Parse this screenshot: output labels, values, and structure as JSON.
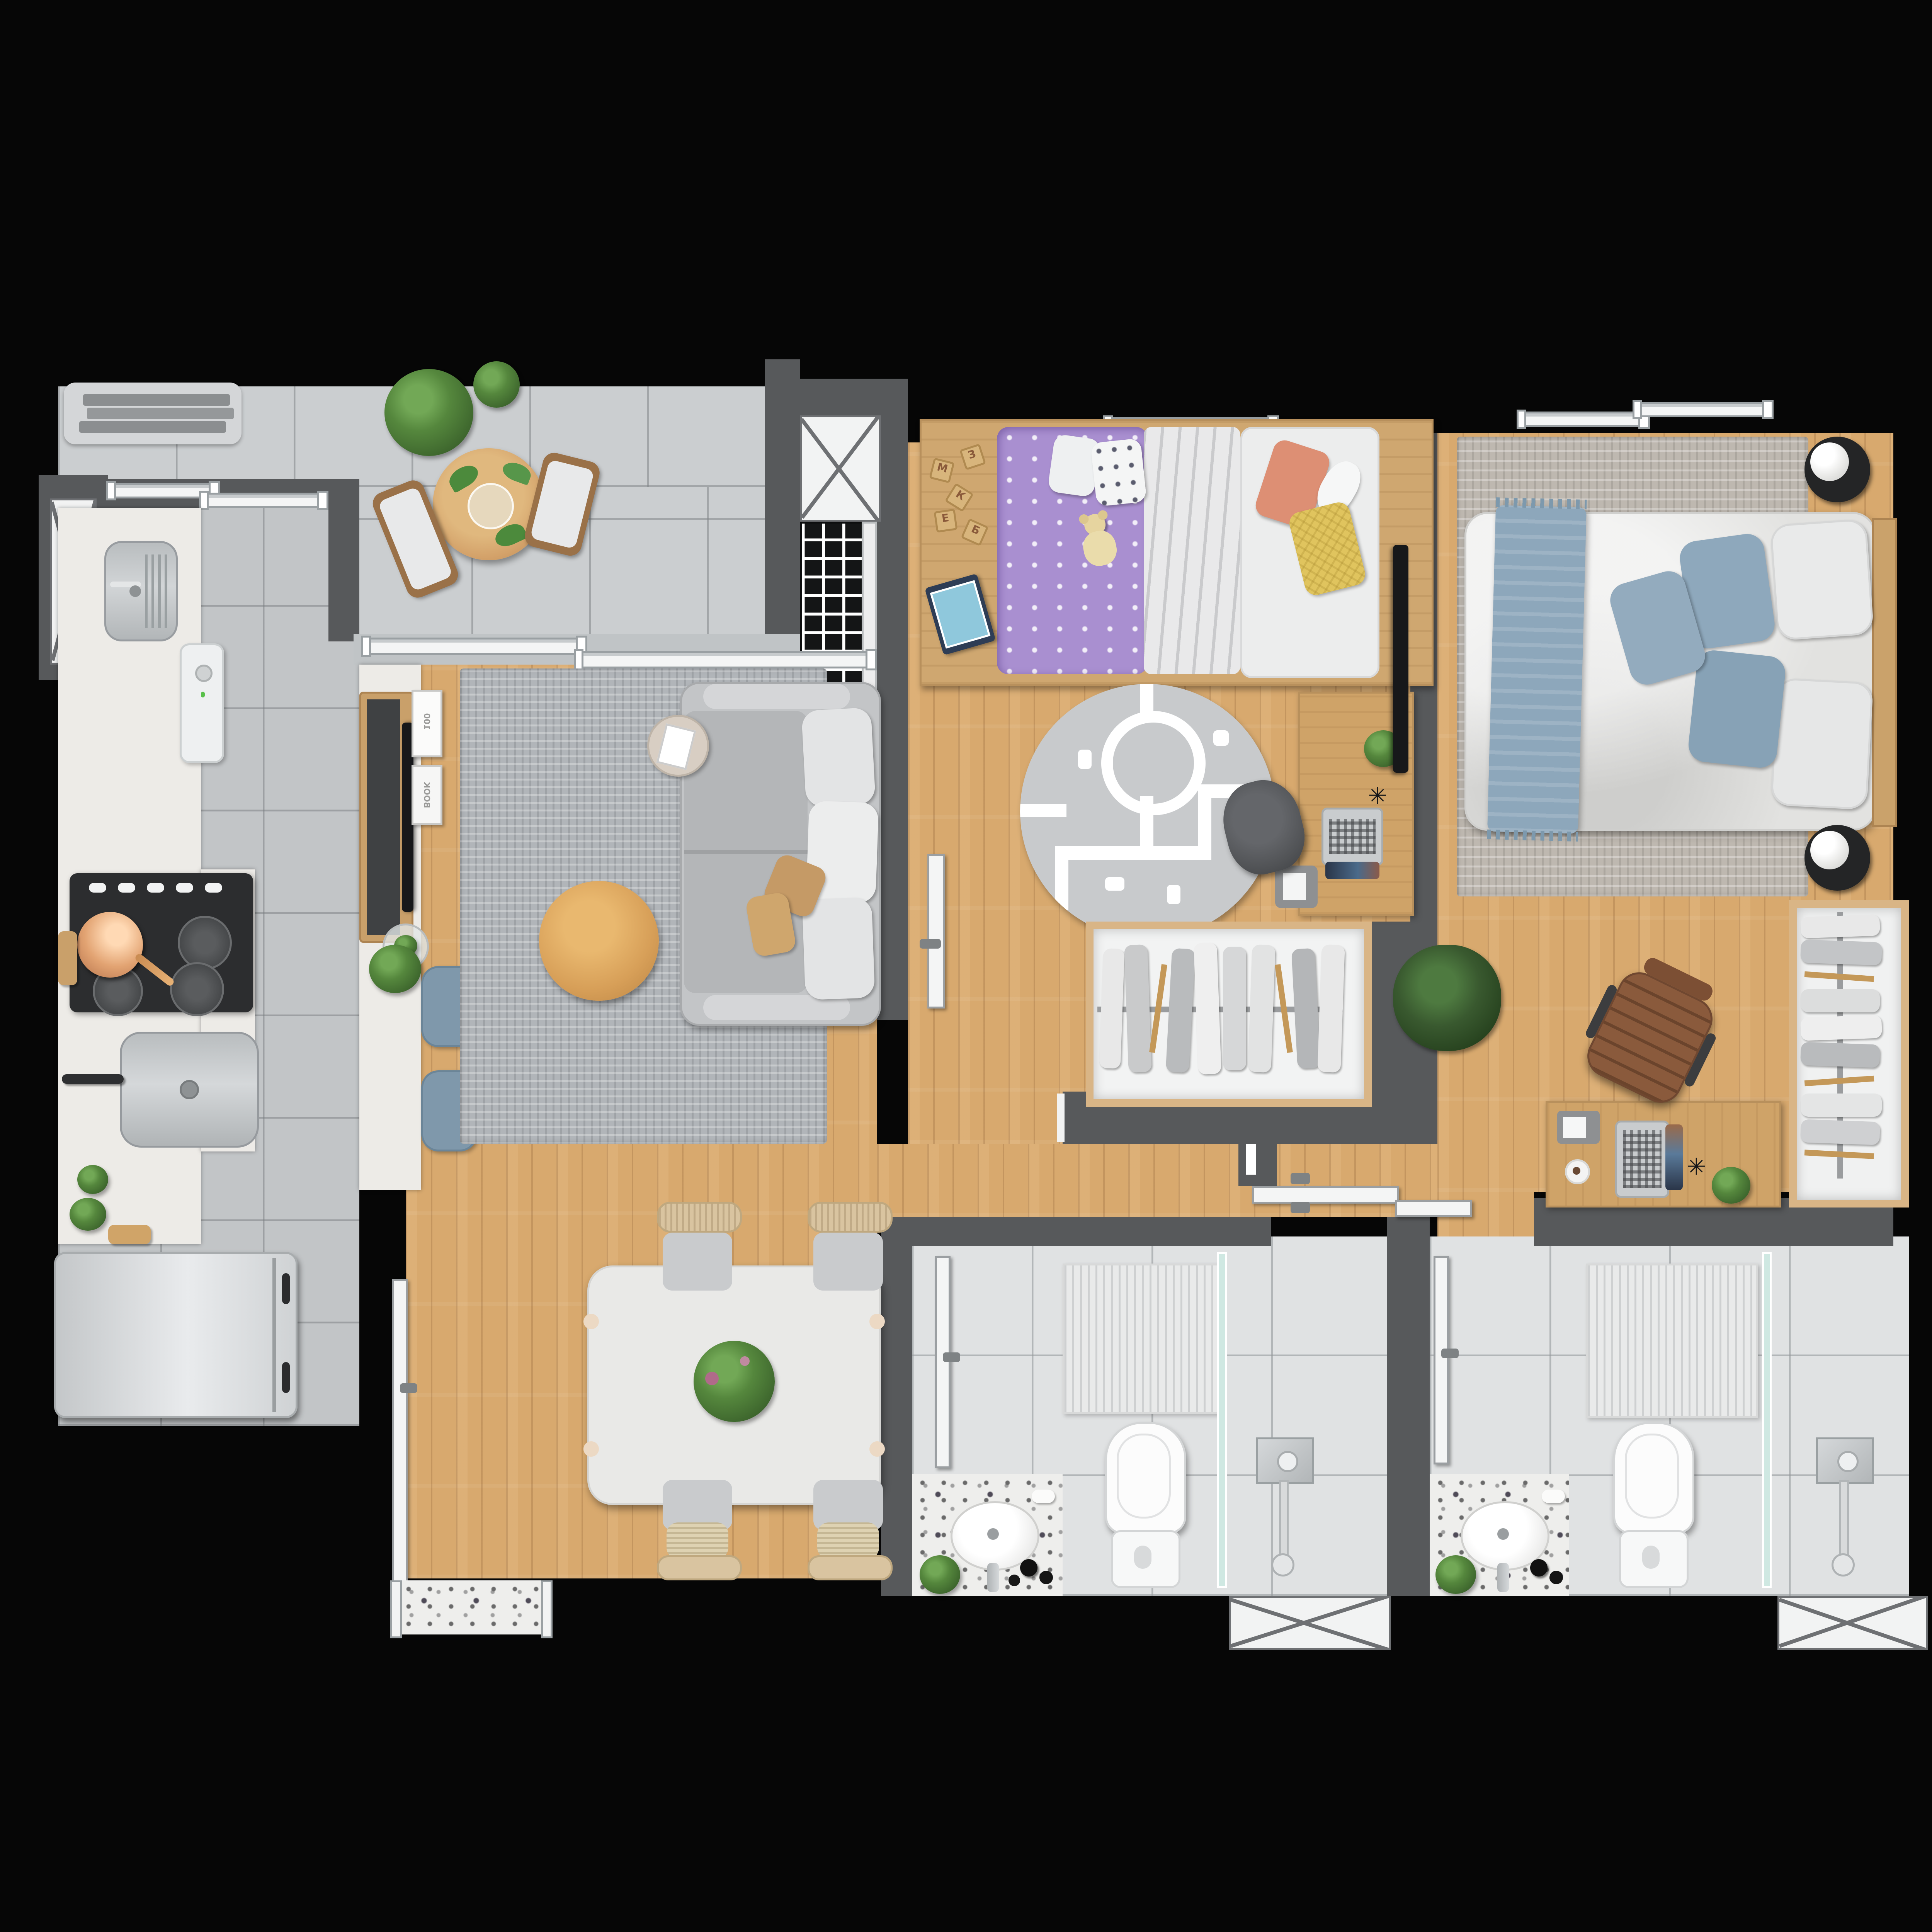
{
  "scene": {
    "type": "top-down-apartment-floor-plan-render",
    "rooms": [
      "balcony-terrace",
      "service-area",
      "kitchen",
      "living-room",
      "dining-area",
      "kids-bedroom",
      "master-bedroom",
      "hallway",
      "bathroom-1",
      "bathroom-2"
    ]
  },
  "colors": {
    "bg": "#060606",
    "wall": "#57595b",
    "wall_dark": "#3f4143",
    "wood": "#d8a96e",
    "wood_furniture": "#cfa368",
    "closet_wood": "#d9b586",
    "tile_balcony": "#cbced0",
    "tile_kitchen": "#c2c5c7",
    "tile_bath": "#e0e2e3",
    "counter": "#edebe7",
    "granite": "#eeeeec",
    "rug_living": "#b1b5b9",
    "rug_master": "#beb8b0",
    "rug_kids": "#c8cacc",
    "sofa": "#c3c5c7",
    "cushion_white": "#e3e4e5",
    "pillow_tan": "#c59a66",
    "ottoman": "#d79f58",
    "kids_purple": "#a98fd0",
    "pillow_coral": "#dd8f74",
    "pillow_yellow": "#e0c45e",
    "throw_blue": "#8da7bb",
    "pillow_blue": "#8ea8bc",
    "stool_blue": "#7f98ab",
    "plant": "#55873d",
    "plant_dark": "#39592f",
    "leather": "#8a5a3c",
    "steel": "#c6c9cb",
    "appliance_black": "#2c2d2f",
    "tv_black": "#17181a",
    "copper": "#e2a372",
    "door": "#f4f5f5",
    "frame": "#9aa0a3",
    "shower_glass": "#cfe8e2"
  },
  "living_room": {
    "book_labels": [
      "100",
      "BOOK"
    ]
  },
  "kids_room": {
    "toy_block_letters": [
      "М",
      "З",
      "К",
      "Е",
      "Б"
    ]
  }
}
